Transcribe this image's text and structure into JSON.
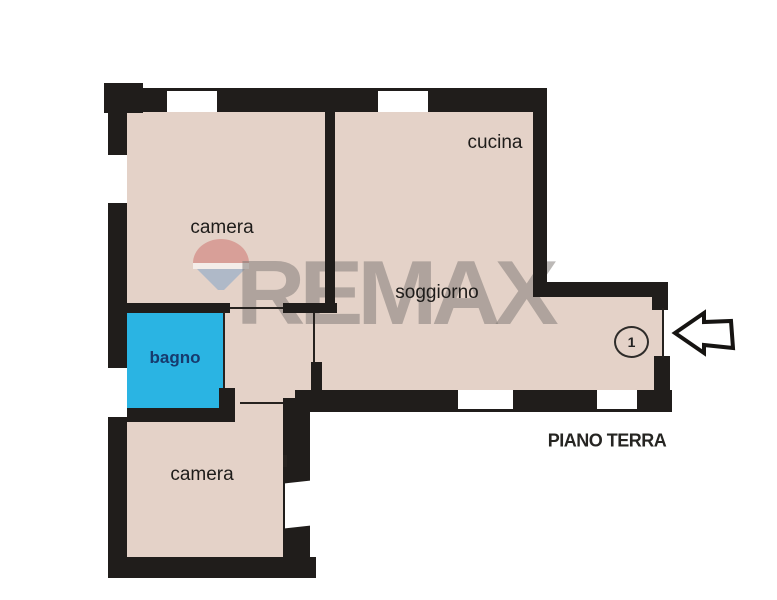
{
  "plan": {
    "rooms": [
      {
        "name": "camera-top",
        "label": "camera"
      },
      {
        "name": "cucina",
        "label": "cucina"
      },
      {
        "name": "soggiorno",
        "label": "soggiorno"
      },
      {
        "name": "bagno",
        "label": "bagno"
      },
      {
        "name": "camera-bottom",
        "label": "camera"
      }
    ],
    "floor_label": "PIANO TERRA",
    "entrance": {
      "number": "1"
    },
    "watermark": {
      "text": "REMAX"
    },
    "colors": {
      "room_fill": "#e4d2c8",
      "bathroom_fill": "#2ab4e3",
      "wall": "#201d1b",
      "bathroom_text": "#173a6d",
      "watermark_gray": "#7e7874",
      "balloon_red": "#d6978f",
      "balloon_blue": "#a9b6c8"
    }
  }
}
